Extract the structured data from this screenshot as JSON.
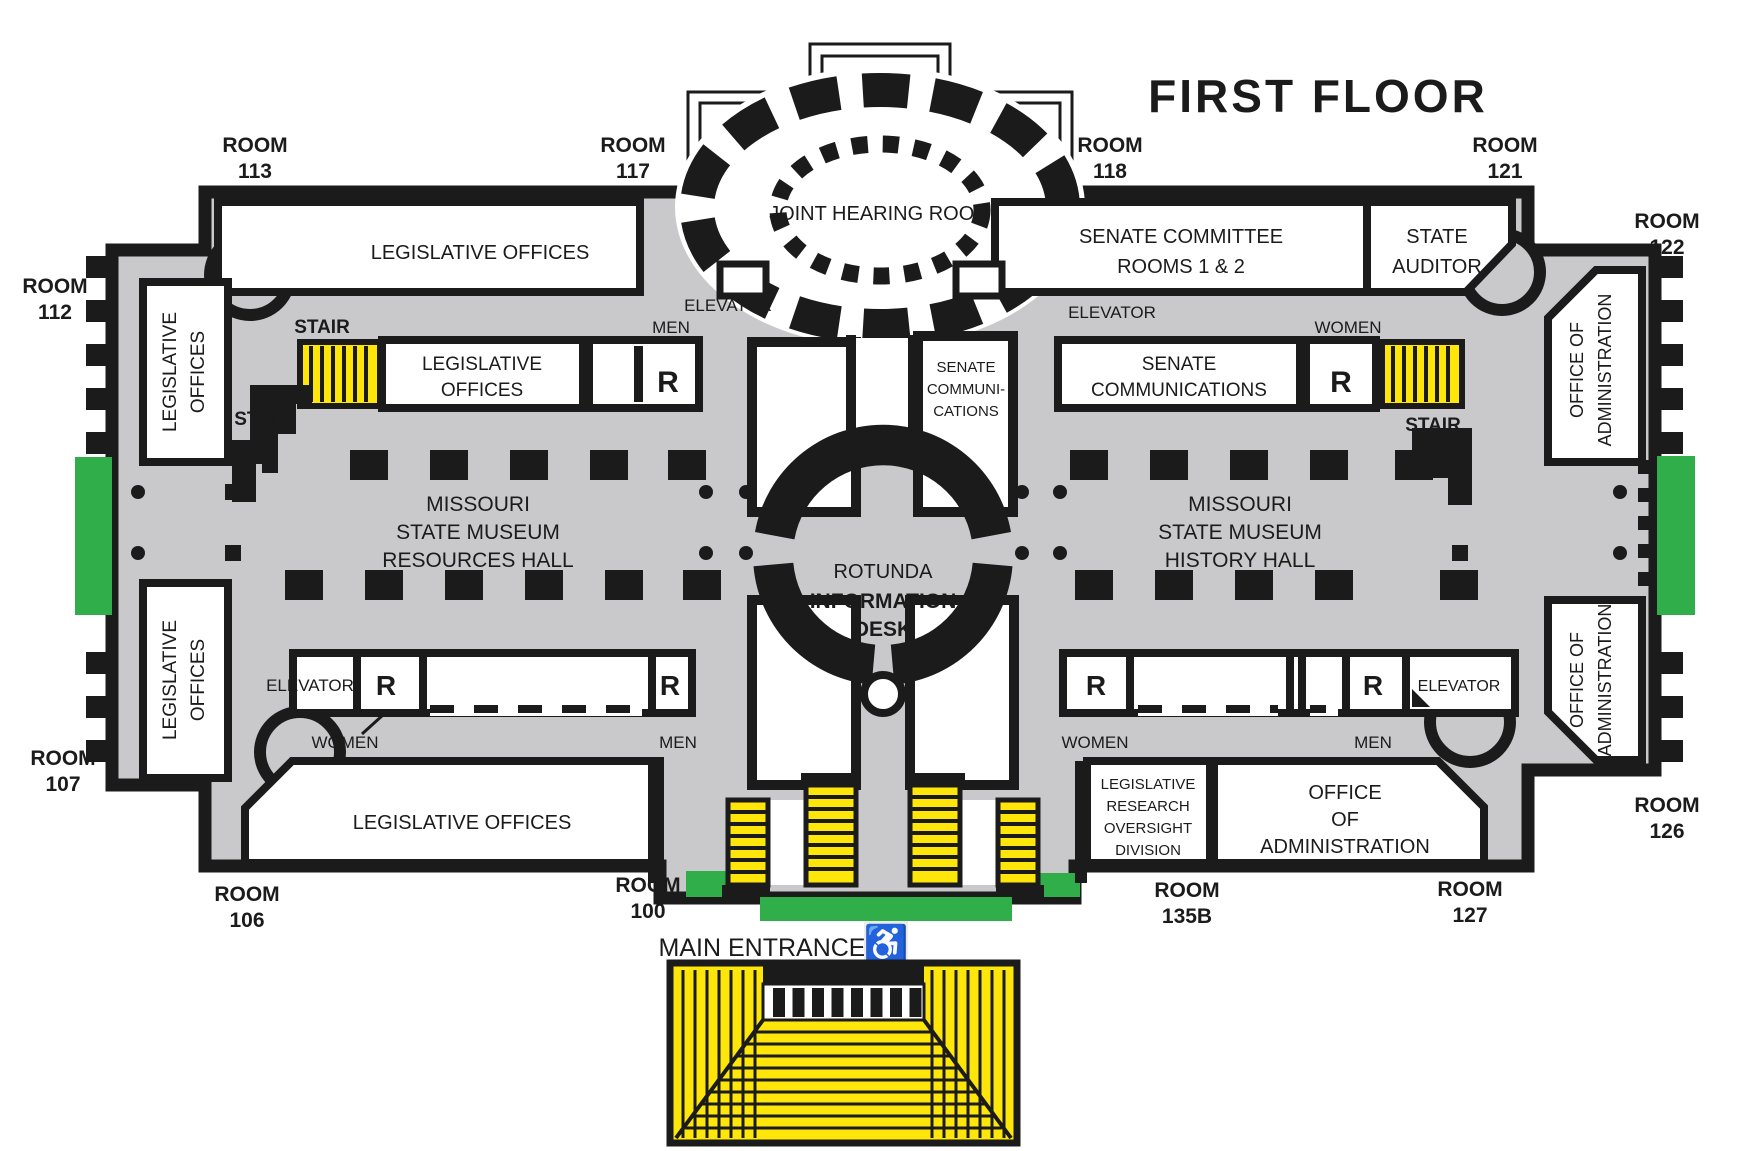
{
  "title": "FIRST FLOOR",
  "labels": {
    "room": "ROOM",
    "stair": "STAIR",
    "elevator": "ELEVATOR",
    "men": "MEN",
    "women": "WOMEN",
    "restroom": "R",
    "main_entrance": "MAIN ENTRANCE",
    "wheelchair_icon": "♿"
  },
  "room_numbers": {
    "n113": "113",
    "n117": "117",
    "n118": "118",
    "n121": "121",
    "n122": "122",
    "n112": "112",
    "n107": "107",
    "n106": "106",
    "n100": "100",
    "n135b": "135B",
    "n127": "127",
    "n126": "126"
  },
  "areas": {
    "joint_hearing_room": "JOINT HEARING ROOM",
    "legislative_offices": "LEGISLATIVE OFFICES",
    "legislative": "LEGISLATIVE",
    "offices": "OFFICES",
    "senate_committee": "SENATE COMMITTEE",
    "rooms_1_2": "ROOMS 1 & 2",
    "state": "STATE",
    "auditor": "AUDITOR",
    "senate": "SENATE",
    "communications": "COMMUNICATIONS",
    "communi": "COMMUNI-",
    "cations": "CATIONS",
    "missouri": "MISSOURI",
    "state_museum": "STATE MUSEUM",
    "resources_hall": "RESOURCES HALL",
    "history_hall": "HISTORY HALL",
    "rotunda": "ROTUNDA",
    "information": "INFORMATION",
    "desk": "DESK",
    "office_of": "OFFICE OF",
    "administration": "ADMINISTRATION",
    "office": "OFFICE",
    "of": "OF",
    "research": "RESEARCH",
    "oversight": "OVERSIGHT",
    "division": "DIVISION"
  },
  "colors": {
    "corridor": "#c9c9cb",
    "wall": "#1b1b1b",
    "stair_yellow": "#ffe60a",
    "accent_green": "#2fae4a",
    "room_white": "#ffffff"
  }
}
